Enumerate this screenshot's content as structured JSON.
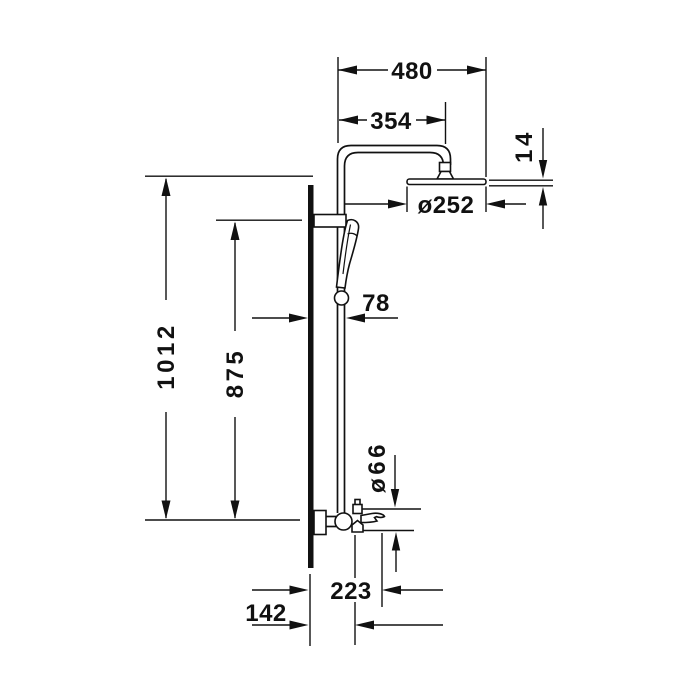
{
  "drawing": {
    "title": "shower-system-side-elevation",
    "background_color": "#ffffff",
    "line_color": "#111111",
    "unit_style": "bold-sans-dimension-figures",
    "dimensions": {
      "overall_width": {
        "label": "480"
      },
      "arm_projection": {
        "label": "354"
      },
      "head_thickness": {
        "label": "14"
      },
      "rain_head_diameter": {
        "label": "ø252"
      },
      "overall_height": {
        "label": "1012"
      },
      "slide_bar_height": {
        "label": "875"
      },
      "bar_wall_distance": {
        "label": "78"
      },
      "mixer_diameter": {
        "label": "ø66"
      },
      "spout_projection": {
        "label": "223"
      },
      "mixer_wall_distance": {
        "label": "142"
      }
    }
  }
}
